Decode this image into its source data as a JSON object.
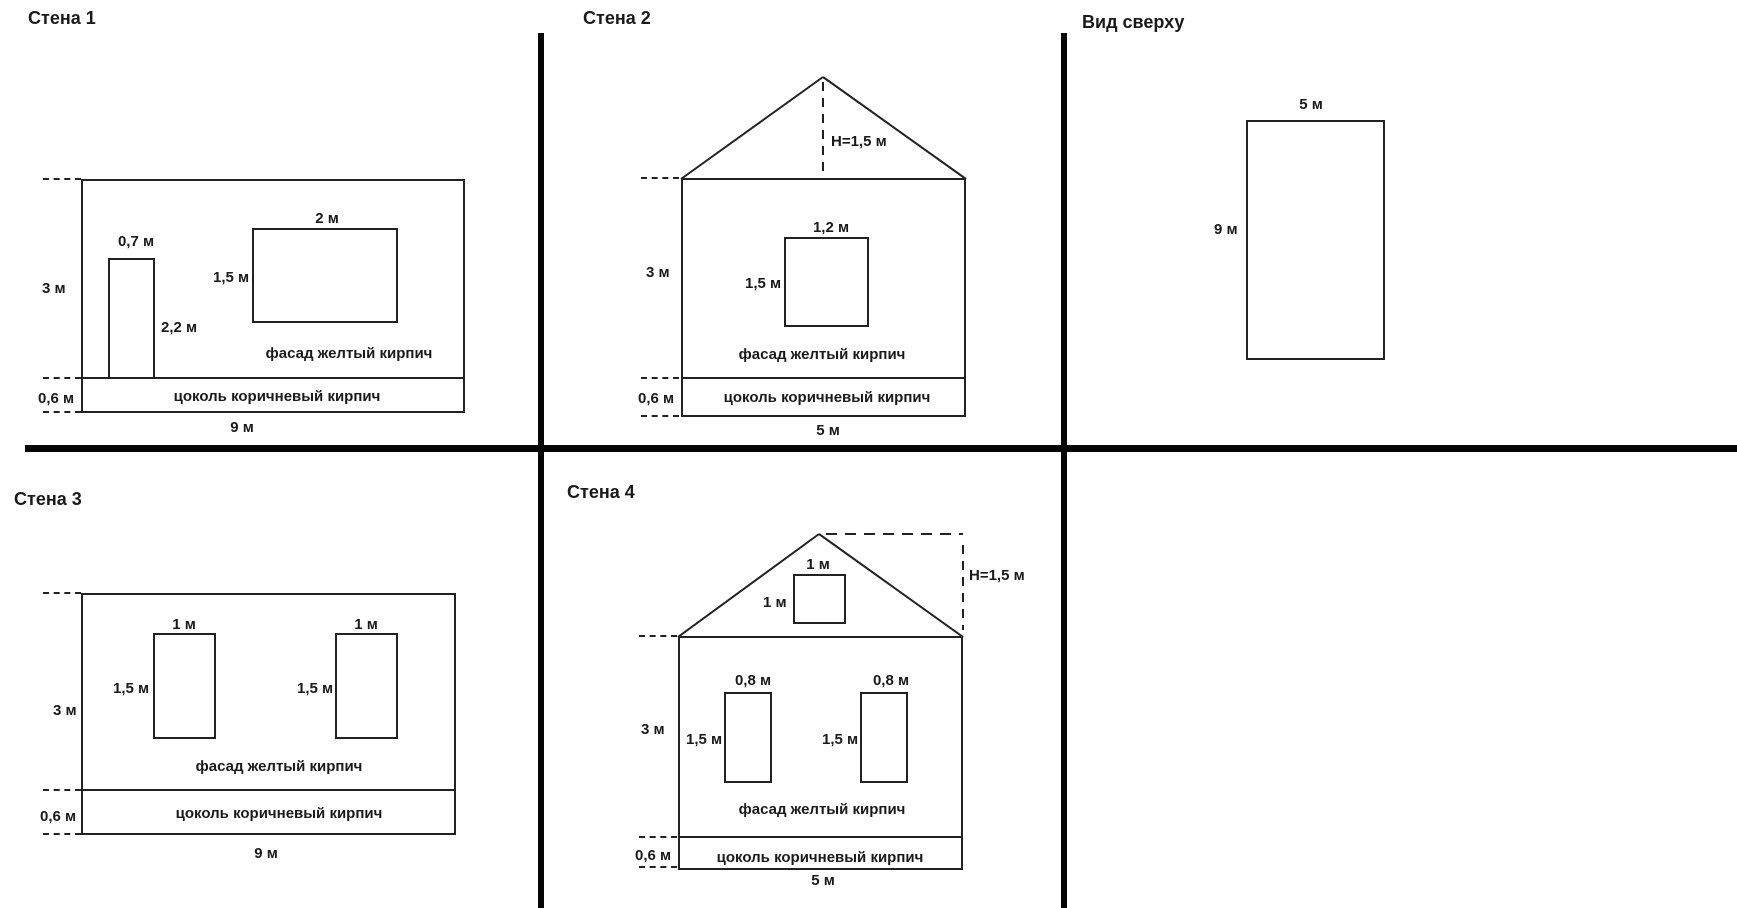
{
  "diagram": {
    "background": "#ffffff",
    "line_color": "#222222",
    "divider_color": "#050505",
    "panels": {
      "wall1": {
        "title": "Стена 1",
        "wall_height": "3 м",
        "plinth_height": "0,6 м",
        "wall_width": "9 м",
        "door": {
          "width": "0,7 м",
          "height": "2,2 м"
        },
        "window": {
          "width": "2 м",
          "height": "1,5 м"
        },
        "facade_material": "фасад желтый кирпич",
        "plinth_material": "цоколь коричневый кирпич"
      },
      "wall2": {
        "title": "Стена 2",
        "roof_height": "H=1,5 м",
        "wall_height": "3 м",
        "plinth_height": "0,6 м",
        "wall_width": "5 м",
        "window": {
          "width": "1,2 м",
          "height": "1,5 м"
        },
        "facade_material": "фасад желтый кирпич",
        "plinth_material": "цоколь коричневый кирпич"
      },
      "top_view": {
        "title": "Вид сверху",
        "width": "5 м",
        "depth": "9 м"
      },
      "wall3": {
        "title": "Стена 3",
        "wall_height": "3 м",
        "plinth_height": "0,6 м",
        "wall_width": "9 м",
        "window1": {
          "width": "1 м",
          "height": "1,5 м"
        },
        "window2": {
          "width": "1 м",
          "height": "1,5 м"
        },
        "facade_material": "фасад желтый кирпич",
        "plinth_material": "цоколь коричневый кирпич"
      },
      "wall4": {
        "title": "Стена 4",
        "roof_height": "H=1,5 м",
        "attic_window": {
          "width": "1 м",
          "height": "1 м"
        },
        "wall_height": "3 м",
        "plinth_height": "0,6 м",
        "wall_width": "5 м",
        "window1": {
          "width": "0,8 м",
          "height": "1,5 м"
        },
        "window2": {
          "width": "0,8 м",
          "height": "1,5 м"
        },
        "facade_material": "фасад желтый кирпич",
        "plinth_material": "цоколь коричневый кирпич"
      }
    }
  }
}
